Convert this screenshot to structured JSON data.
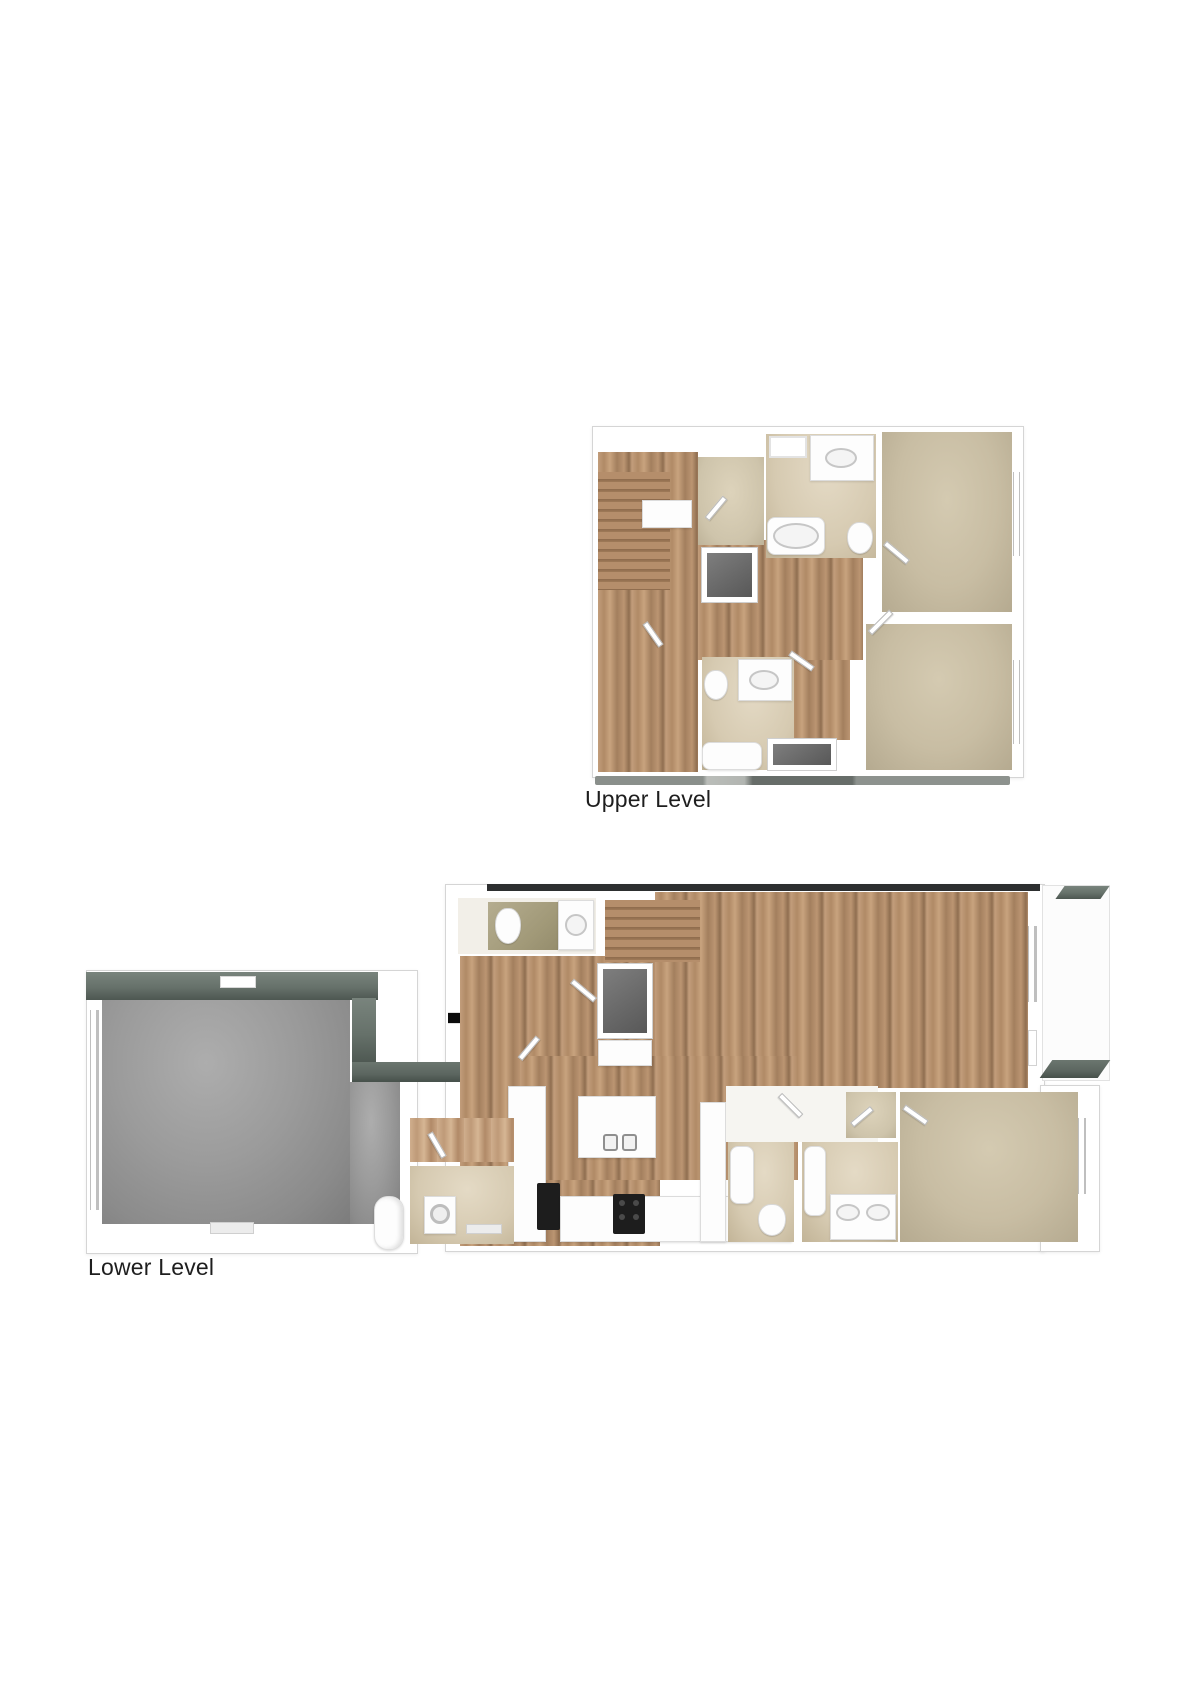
{
  "floorplans": {
    "upper": {
      "label": "Upper Level"
    },
    "lower": {
      "label": "Lower Level"
    }
  },
  "icons": {
    "entry_arrow": "right-arrow"
  },
  "colors": {
    "background": "#ffffff",
    "wall": "#ffffff",
    "wall_outline": "#d5d5d5",
    "wood_floor": "#b48e6a",
    "carpet": "#c8bda3",
    "bath_tile": "#d6cab1",
    "entry_bath_tile": "#a29a79",
    "garage_concrete": "#9b9b9b",
    "roof_cap_gray_green": "#66716a",
    "house_top_edge": "#2d2f30",
    "shower_floor": "#717171",
    "appliance_dark": "#1d1d1d",
    "entry_arrow": "#0c0c0c",
    "label_text": "#1e1e1e"
  }
}
